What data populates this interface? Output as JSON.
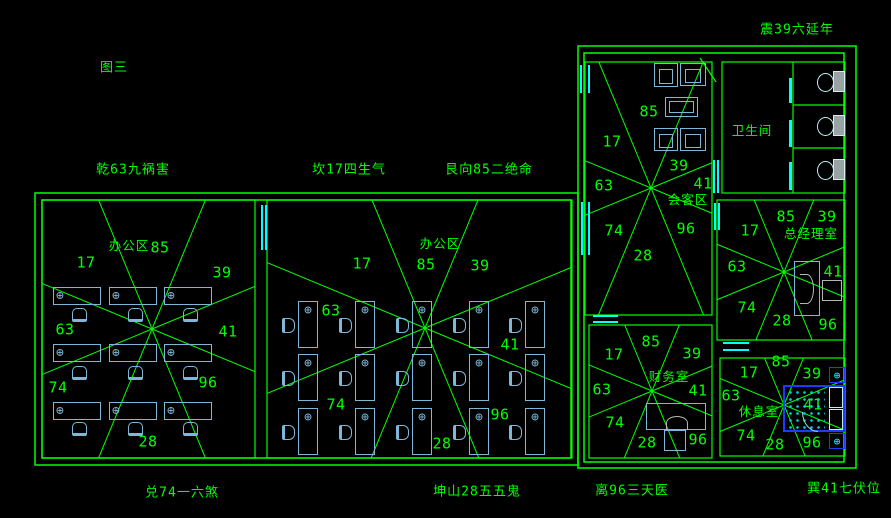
{
  "colors": {
    "bg": "#000000",
    "line": "#00ff00",
    "furniture": "#7fb7d9",
    "window": "#00ffff",
    "bed_blue": "#1a3cff",
    "gray": "#b5b5b5"
  },
  "icons": {
    "workstation": "⊕",
    "nightstand": "⊕"
  },
  "perimeter_labels": [
    {
      "id": "figure-title",
      "text": "图三",
      "x": 114,
      "y": 68
    },
    {
      "id": "zhen",
      "text": "震39六延年",
      "x": 797,
      "y": 30
    },
    {
      "id": "qian",
      "text": "乾63九祸害",
      "x": 133,
      "y": 170
    },
    {
      "id": "kan",
      "text": "坎17四生气",
      "x": 349,
      "y": 170
    },
    {
      "id": "gen",
      "text": "艮向85二绝命",
      "x": 489,
      "y": 170
    },
    {
      "id": "dui",
      "text": "兑74一六煞",
      "x": 182,
      "y": 493
    },
    {
      "id": "kun",
      "text": "坤山28五五鬼",
      "x": 477,
      "y": 492
    },
    {
      "id": "li",
      "text": "离96三天医",
      "x": 632,
      "y": 491
    },
    {
      "id": "xun",
      "text": "巽41七伏位",
      "x": 844,
      "y": 489
    }
  ],
  "walls": {
    "outer": [
      [
        35,
        193,
        543,
        272
      ],
      [
        42,
        200,
        529,
        258
      ],
      [
        578,
        46,
        278,
        422
      ],
      [
        584,
        53,
        260,
        409
      ]
    ],
    "lines": [
      [
        793,
        62,
        793,
        193
      ],
      [
        793,
        105,
        845,
        105
      ],
      [
        793,
        148,
        845,
        148
      ],
      [
        700,
        58,
        716,
        82
      ]
    ]
  },
  "rooms": [
    {
      "id": "office-left",
      "label": "办公区",
      "label_x": 129,
      "label_y": 246,
      "rect": [
        42,
        200,
        213,
        258
      ],
      "star": [
        152,
        329
      ],
      "numbers": [
        {
          "v": "17",
          "x": 86,
          "y": 263
        },
        {
          "v": "85",
          "x": 160,
          "y": 248
        },
        {
          "v": "39",
          "x": 222,
          "y": 273
        },
        {
          "v": "63",
          "x": 65,
          "y": 330
        },
        {
          "v": "41",
          "x": 228,
          "y": 332
        },
        {
          "v": "74",
          "x": 58,
          "y": 388
        },
        {
          "v": "96",
          "x": 208,
          "y": 383
        },
        {
          "v": "28",
          "x": 148,
          "y": 442
        }
      ]
    },
    {
      "id": "office-mid",
      "label": "办公区",
      "label_x": 440,
      "label_y": 244,
      "rect": [
        267,
        200,
        305,
        258
      ],
      "star": [
        425,
        328
      ],
      "numbers": [
        {
          "v": "17",
          "x": 362,
          "y": 264
        },
        {
          "v": "85",
          "x": 426,
          "y": 265
        },
        {
          "v": "39",
          "x": 480,
          "y": 266
        },
        {
          "v": "63",
          "x": 331,
          "y": 311
        },
        {
          "v": "41",
          "x": 510,
          "y": 345
        },
        {
          "v": "74",
          "x": 336,
          "y": 405
        },
        {
          "v": "96",
          "x": 500,
          "y": 415
        },
        {
          "v": "28",
          "x": 442,
          "y": 444
        }
      ]
    },
    {
      "id": "reception",
      "label": "会客区",
      "label_x": 688,
      "label_y": 200,
      "rect": [
        585,
        62,
        127,
        253
      ],
      "star": [
        651,
        188
      ],
      "numbers": [
        {
          "v": "85",
          "x": 649,
          "y": 112
        },
        {
          "v": "17",
          "x": 612,
          "y": 142
        },
        {
          "v": "39",
          "x": 679,
          "y": 166
        },
        {
          "v": "63",
          "x": 604,
          "y": 186
        },
        {
          "v": "41",
          "x": 703,
          "y": 184
        },
        {
          "v": "74",
          "x": 614,
          "y": 231
        },
        {
          "v": "96",
          "x": 686,
          "y": 229
        },
        {
          "v": "28",
          "x": 643,
          "y": 256
        }
      ]
    },
    {
      "id": "bathroom",
      "label": "卫生间",
      "label_x": 752,
      "label_y": 131,
      "rect": [
        722,
        62,
        123,
        131
      ],
      "star": null,
      "numbers": []
    },
    {
      "id": "gm-office",
      "label": "总经理室",
      "label_x": 811,
      "label_y": 234,
      "rect": [
        717,
        200,
        128,
        140
      ],
      "star": [
        784,
        272
      ],
      "numbers": [
        {
          "v": "85",
          "x": 786,
          "y": 217
        },
        {
          "v": "39",
          "x": 827,
          "y": 217
        },
        {
          "v": "17",
          "x": 750,
          "y": 231
        },
        {
          "v": "63",
          "x": 737,
          "y": 267
        },
        {
          "v": "41",
          "x": 833,
          "y": 272
        },
        {
          "v": "74",
          "x": 747,
          "y": 308
        },
        {
          "v": "28",
          "x": 782,
          "y": 321
        },
        {
          "v": "96",
          "x": 828,
          "y": 325
        }
      ]
    },
    {
      "id": "finance",
      "label": "财务室",
      "label_x": 669,
      "label_y": 377,
      "rect": [
        589,
        325,
        123,
        133
      ],
      "star": [
        652,
        391
      ],
      "numbers": [
        {
          "v": "85",
          "x": 651,
          "y": 342
        },
        {
          "v": "17",
          "x": 614,
          "y": 355
        },
        {
          "v": "39",
          "x": 692,
          "y": 354
        },
        {
          "v": "63",
          "x": 602,
          "y": 390
        },
        {
          "v": "41",
          "x": 698,
          "y": 391
        },
        {
          "v": "74",
          "x": 615,
          "y": 423
        },
        {
          "v": "28",
          "x": 647,
          "y": 443
        },
        {
          "v": "96",
          "x": 698,
          "y": 440
        }
      ]
    },
    {
      "id": "rest-room",
      "label": "休息室",
      "label_x": 759,
      "label_y": 412,
      "rect": [
        720,
        358,
        125,
        98
      ],
      "star": [
        784,
        405
      ],
      "numbers": [
        {
          "v": "85",
          "x": 781,
          "y": 362
        },
        {
          "v": "17",
          "x": 749,
          "y": 373
        },
        {
          "v": "39",
          "x": 812,
          "y": 374
        },
        {
          "v": "63",
          "x": 731,
          "y": 396
        },
        {
          "v": "41",
          "x": 813,
          "y": 405
        },
        {
          "v": "74",
          "x": 746,
          "y": 436
        },
        {
          "v": "28",
          "x": 775,
          "y": 445
        },
        {
          "v": "96",
          "x": 812,
          "y": 443
        }
      ]
    }
  ],
  "windows": [
    {
      "o": "v",
      "x": 580,
      "y": 65,
      "w": 10,
      "h": 28
    },
    {
      "o": "v",
      "x": 581,
      "y": 202,
      "w": 9,
      "h": 53
    },
    {
      "o": "h",
      "x": 593,
      "y": 315,
      "w": 25,
      "h": 8
    },
    {
      "o": "v",
      "x": 261,
      "y": 205,
      "w": 6,
      "h": 45
    },
    {
      "o": "h",
      "x": 723,
      "y": 342,
      "w": 26,
      "h": 9
    },
    {
      "o": "v",
      "x": 713,
      "y": 160,
      "w": 6,
      "h": 33
    },
    {
      "o": "v",
      "x": 714,
      "y": 203,
      "w": 6,
      "h": 27
    }
  ],
  "door_strips": [
    [
      789,
      78,
      25
    ],
    [
      789,
      120,
      27
    ],
    [
      789,
      162,
      28
    ]
  ],
  "furniture": {
    "desk_grid_h": {
      "cols": [
        53,
        109,
        164
      ],
      "rows": [
        287,
        344,
        402
      ],
      "w": 48,
      "h": 18,
      "chair_dx": 19,
      "chair_rows": [
        308,
        366,
        422
      ],
      "chair_w": 15,
      "chair_h": 14
    },
    "desk_grid_v": {
      "cols": [
        298,
        355,
        412,
        469,
        525
      ],
      "rows": [
        301,
        354,
        408
      ],
      "w": 20,
      "h": 47,
      "chair_dx": -16,
      "chair_dy": 17,
      "chair_w": 13,
      "chair_h": 15
    },
    "sofas": [
      [
        654,
        63,
        24,
        24
      ],
      [
        680,
        63,
        26,
        23
      ],
      [
        654,
        128,
        24,
        23
      ],
      [
        680,
        128,
        26,
        23
      ]
    ],
    "table": [
      665,
      97,
      33,
      20
    ],
    "toilets": [
      {
        "x": 817,
        "y": 71
      },
      {
        "x": 817,
        "y": 115
      },
      {
        "x": 817,
        "y": 159
      }
    ],
    "gm_desk": [
      794,
      261,
      26,
      55
    ],
    "gm_curve": [
      800,
      274,
      14,
      30
    ],
    "gm_chair": [
      822,
      280,
      20,
      21
    ],
    "fin_desk": [
      646,
      403,
      60,
      27
    ],
    "fin_curve": [
      666,
      416,
      22,
      14
    ],
    "fin_chair": [
      664,
      430,
      22,
      21
    ],
    "bed": [
      783,
      385,
      62,
      47
    ],
    "bed_dots": [
      787,
      389,
      38,
      40
    ],
    "pillows": [
      [
        829,
        387,
        14,
        21
      ],
      [
        829,
        409,
        14,
        21
      ]
    ],
    "blanket_arc": [
      802,
      412,
      16,
      20
    ],
    "nightstands": [
      [
        829,
        367,
        16,
        16
      ],
      [
        829,
        433,
        16,
        16
      ]
    ]
  }
}
